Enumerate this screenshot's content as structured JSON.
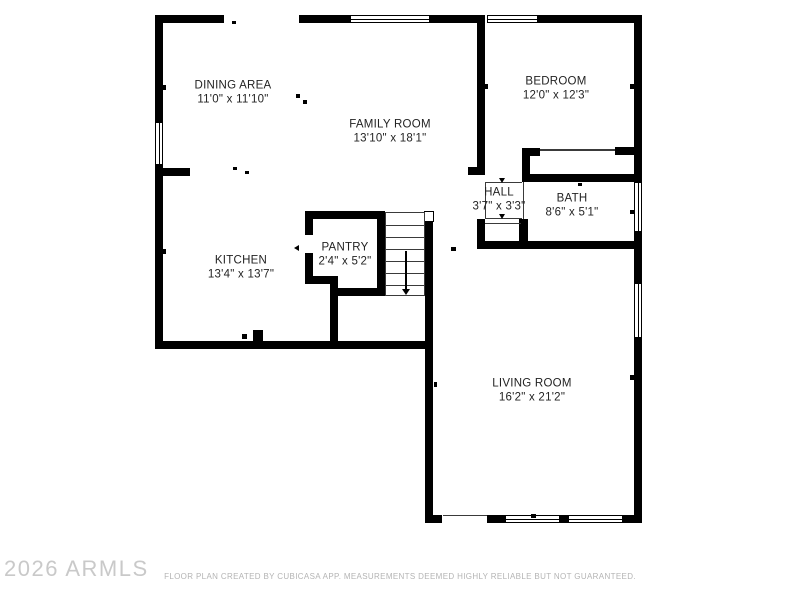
{
  "plan": {
    "watermark": "2026 ARMLS",
    "disclaimer": "FLOOR PLAN CREATED BY CUBICASA APP. MEASUREMENTS DEEMED HIGHLY RELIABLE BUT NOT GUARANTEED.",
    "colors": {
      "wall": "#000000",
      "background": "#ffffff",
      "label": "#232323",
      "watermark": "#c9c9c9",
      "disclaimer": "#b4b4b4",
      "thin_line": "#3a3a3a"
    },
    "rooms": [
      {
        "id": "dining",
        "name": "DINING AREA",
        "dims": "11'0\" x 11'10\"",
        "cx": 233,
        "cy": 93
      },
      {
        "id": "family",
        "name": "FAMILY ROOM",
        "dims": "13'10\" x 18'1\"",
        "cx": 390,
        "cy": 132
      },
      {
        "id": "bedroom",
        "name": "BEDROOM",
        "dims": "12'0\" x 12'3\"",
        "cx": 556,
        "cy": 89
      },
      {
        "id": "kitchen",
        "name": "KITCHEN",
        "dims": "13'4\" x 13'7\"",
        "cx": 241,
        "cy": 268
      },
      {
        "id": "pantry",
        "name": "PANTRY",
        "dims": "2'4\" x 5'2\"",
        "cx": 345,
        "cy": 255
      },
      {
        "id": "hall",
        "name": "HALL",
        "dims": "3'7\" x 3'3\"",
        "cx": 499,
        "cy": 200
      },
      {
        "id": "bath",
        "name": "BATH",
        "dims": "8'6\" x 5'1\"",
        "cx": 572,
        "cy": 206
      },
      {
        "id": "living",
        "name": "LIVING ROOM",
        "dims": "16'2\" x 21'2\"",
        "cx": 532,
        "cy": 391
      }
    ]
  },
  "geometry": {
    "walls": [
      {
        "x": 155,
        "y": 15,
        "w": 69,
        "h": 8
      },
      {
        "x": 299,
        "y": 15,
        "w": 51,
        "h": 8
      },
      {
        "x": 430,
        "y": 15,
        "w": 55,
        "h": 8
      },
      {
        "x": 538,
        "y": 15,
        "w": 104,
        "h": 8
      },
      {
        "x": 155,
        "y": 15,
        "w": 8,
        "h": 107
      },
      {
        "x": 155,
        "y": 165,
        "w": 8,
        "h": 184
      },
      {
        "x": 163,
        "y": 168,
        "w": 27,
        "h": 8
      },
      {
        "x": 155,
        "y": 341,
        "w": 278,
        "h": 8
      },
      {
        "x": 253,
        "y": 330,
        "w": 10,
        "h": 11
      },
      {
        "x": 634,
        "y": 15,
        "w": 8,
        "h": 167
      },
      {
        "x": 634,
        "y": 232,
        "w": 8,
        "h": 51
      },
      {
        "x": 634,
        "y": 338,
        "w": 8,
        "h": 185
      },
      {
        "x": 477,
        "y": 15,
        "w": 8,
        "h": 160
      },
      {
        "x": 468,
        "y": 167,
        "w": 17,
        "h": 8
      },
      {
        "x": 522,
        "y": 148,
        "w": 18,
        "h": 8
      },
      {
        "x": 615,
        "y": 147,
        "w": 19,
        "h": 8
      },
      {
        "x": 522,
        "y": 148,
        "w": 8,
        "h": 34
      },
      {
        "x": 522,
        "y": 174,
        "w": 112,
        "h": 8
      },
      {
        "x": 519,
        "y": 219,
        "w": 9,
        "h": 30
      },
      {
        "x": 477,
        "y": 219,
        "w": 8,
        "h": 30
      },
      {
        "x": 477,
        "y": 241,
        "w": 165,
        "h": 8
      },
      {
        "x": 305,
        "y": 211,
        "w": 80,
        "h": 8
      },
      {
        "x": 305,
        "y": 211,
        "w": 8,
        "h": 24
      },
      {
        "x": 305,
        "y": 253,
        "w": 8,
        "h": 31
      },
      {
        "x": 305,
        "y": 276,
        "w": 33,
        "h": 8
      },
      {
        "x": 330,
        "y": 276,
        "w": 8,
        "h": 73
      },
      {
        "x": 337,
        "y": 288,
        "w": 48,
        "h": 8
      },
      {
        "x": 377,
        "y": 211,
        "w": 8,
        "h": 85
      },
      {
        "x": 425,
        "y": 222,
        "w": 8,
        "h": 293
      },
      {
        "x": 425,
        "y": 515,
        "w": 17,
        "h": 8
      },
      {
        "x": 487,
        "y": 515,
        "w": 18,
        "h": 8
      },
      {
        "x": 560,
        "y": 515,
        "w": 8,
        "h": 8
      },
      {
        "x": 623,
        "y": 515,
        "w": 19,
        "h": 8
      }
    ],
    "windows": [
      {
        "x": 350,
        "y": 15,
        "w": 80,
        "h": 8,
        "o": "h"
      },
      {
        "x": 487,
        "y": 15,
        "w": 51,
        "h": 8,
        "o": "h"
      },
      {
        "x": 155,
        "y": 122,
        "w": 8,
        "h": 43,
        "o": "v"
      },
      {
        "x": 505,
        "y": 515,
        "w": 55,
        "h": 8,
        "o": "h"
      },
      {
        "x": 568,
        "y": 515,
        "w": 55,
        "h": 8,
        "o": "h"
      },
      {
        "x": 634,
        "y": 182,
        "w": 8,
        "h": 50,
        "o": "v"
      },
      {
        "x": 634,
        "y": 283,
        "w": 8,
        "h": 55,
        "o": "v"
      },
      {
        "x": 424,
        "y": 211,
        "w": 10,
        "h": 11,
        "o": "none"
      }
    ],
    "openings": [
      {
        "x": 540,
        "y": 149,
        "w": 75,
        "h": 1.5
      },
      {
        "x": 485,
        "y": 182,
        "w": 37,
        "h": 1
      },
      {
        "x": 485,
        "y": 218,
        "w": 37,
        "h": 1
      },
      {
        "x": 485,
        "y": 182,
        "w": 1,
        "h": 37
      },
      {
        "x": 523,
        "y": 182,
        "w": 1,
        "h": 37
      },
      {
        "x": 485,
        "y": 223,
        "w": 36,
        "h": 1
      },
      {
        "x": 443,
        "y": 515,
        "w": 44,
        "h": 1
      }
    ],
    "stairs": {
      "x": 385,
      "y": 212,
      "w": 40,
      "h": 84,
      "treads": [
        12,
        24,
        36,
        48,
        60,
        72
      ],
      "arrow": {
        "x": 404,
        "y1": 250,
        "y2": 288
      }
    },
    "marks": [
      {
        "x": 232,
        "y": 21,
        "w": 4,
        "h": 3
      },
      {
        "x": 296,
        "y": 94,
        "w": 4,
        "h": 4
      },
      {
        "x": 303,
        "y": 100,
        "w": 4,
        "h": 4
      },
      {
        "x": 233,
        "y": 167,
        "w": 4,
        "h": 3
      },
      {
        "x": 245,
        "y": 171,
        "w": 4,
        "h": 3
      },
      {
        "x": 242,
        "y": 334,
        "w": 5,
        "h": 5
      },
      {
        "x": 451,
        "y": 247,
        "w": 5,
        "h": 4
      },
      {
        "x": 531,
        "y": 514,
        "w": 5,
        "h": 4
      },
      {
        "x": 578,
        "y": 183,
        "w": 4,
        "h": 3
      },
      {
        "x": 163,
        "y": 85,
        "w": 3,
        "h": 5
      },
      {
        "x": 163,
        "y": 249,
        "w": 3,
        "h": 5
      },
      {
        "x": 485,
        "y": 84,
        "w": 3,
        "h": 5
      },
      {
        "x": 630,
        "y": 84,
        "w": 4,
        "h": 5
      },
      {
        "x": 630,
        "y": 210,
        "w": 4,
        "h": 4
      },
      {
        "x": 434,
        "y": 382,
        "w": 3,
        "h": 5
      },
      {
        "x": 630,
        "y": 375,
        "w": 4,
        "h": 5
      }
    ],
    "triangles": [
      {
        "x": 294,
        "y": 245,
        "dir": "left"
      },
      {
        "x": 499,
        "y": 178,
        "dir": "down"
      },
      {
        "x": 499,
        "y": 214,
        "dir": "down"
      }
    ]
  }
}
